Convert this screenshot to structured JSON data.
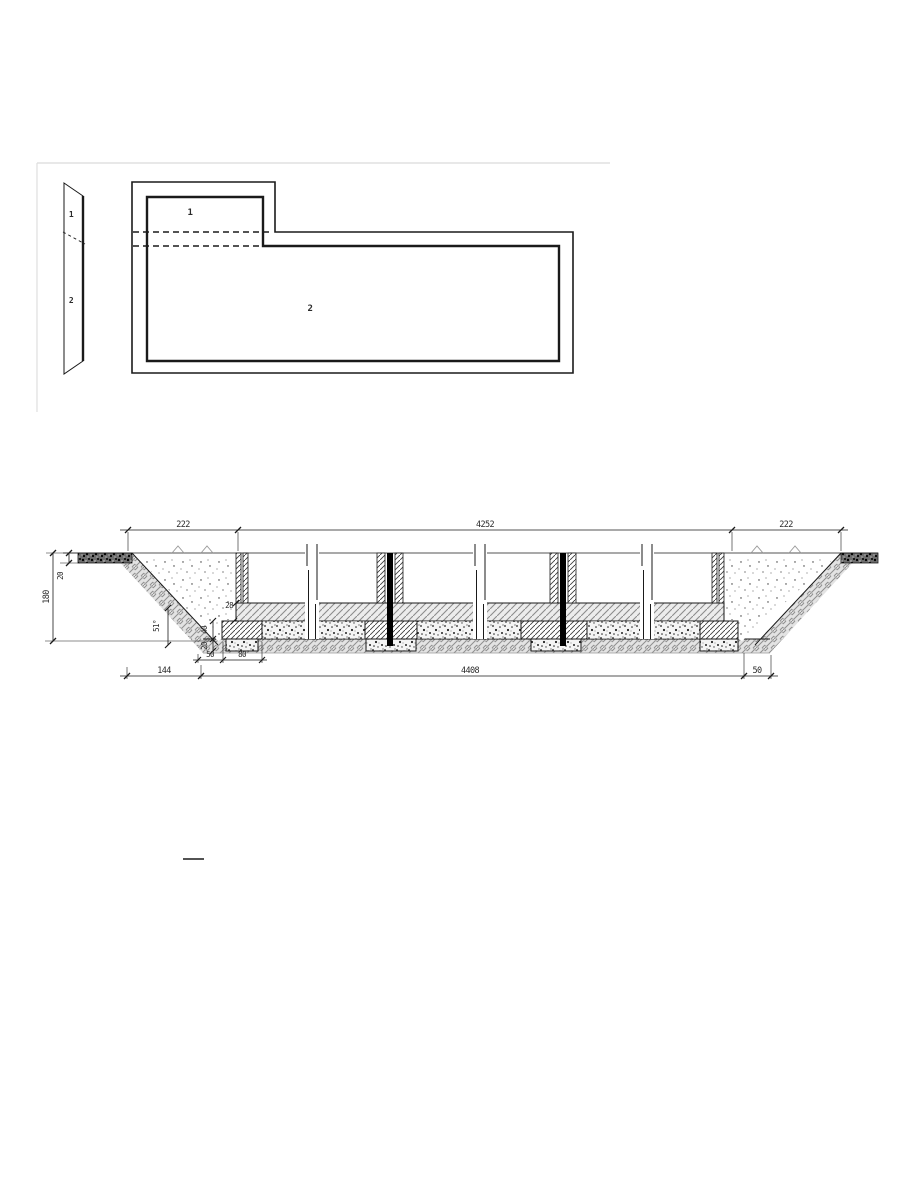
{
  "side_view": {
    "labels": {
      "top": "1",
      "bottom": "2"
    }
  },
  "plan_view": {
    "labels": {
      "area1": "1",
      "area2": "2"
    }
  },
  "section": {
    "dims": {
      "top_left": "222",
      "top_span": "4252",
      "top_right": "222",
      "depth": "180",
      "surface_layer": "20",
      "slab": "28",
      "footing_height": "40",
      "pad_height": "20",
      "slope": "51°",
      "footing_offset": "50",
      "footing_width": "80",
      "bottom_left": "144",
      "bottom_span": "4408",
      "bottom_right": "50"
    }
  },
  "colors": {
    "line": "#1a1a1a",
    "page_border": "#d9d9d9",
    "hatch": "#3f3f3f",
    "soil": "#8f8f8f",
    "background": "#ffffff"
  }
}
